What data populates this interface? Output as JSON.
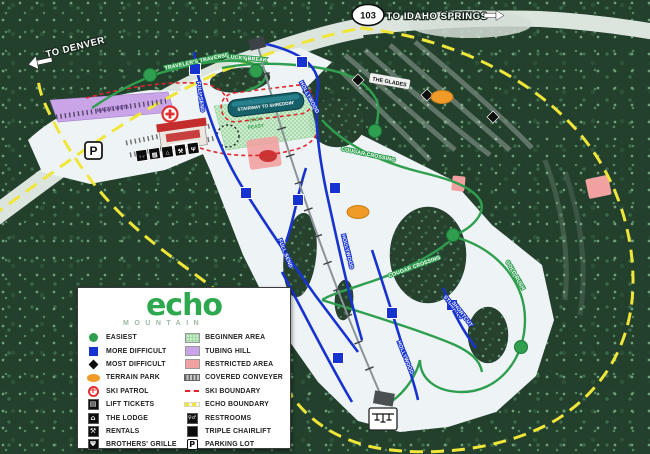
{
  "logo": {
    "name": "echo",
    "tagline": "MOUNTAIN"
  },
  "signs": {
    "route_shield": "103",
    "to_denver": "TO DENVER",
    "to_idaho_springs": "TO IDAHO SPRINGS"
  },
  "trail_labels": {
    "travelers_traverse": "TRAVELER'S TRAVERSE",
    "lucky_break": "LUCKY BREAK",
    "full_send": "FULL SEND",
    "hollywood": "HOLLYWOOD",
    "cougar_crossing": "COUGAR CROSSING",
    "gold_rush": "GOLD RUSH",
    "stumpys_line1": "STUMPY'S",
    "stumpys_line2": "SHORTCUT",
    "the_glades": "THE GLADES",
    "stairway_to_shreddin": "STAIRWAY TO SHREDDIN'",
    "magic_vista": "MAGIC VISTA",
    "beginner_line1": "EASY",
    "beginner_line2": "PEASY"
  },
  "icons": {
    "parking": "P",
    "patrol_cross": "+",
    "restrooms": "♀♂",
    "lift_tickets": "▤",
    "lodge": "⌂",
    "rentals": "⚒",
    "grille": "Ψ"
  },
  "legend": {
    "left": [
      {
        "icon": "green-circle",
        "label": "EASIEST"
      },
      {
        "icon": "blue-square",
        "label": "MORE DIFFICULT"
      },
      {
        "icon": "black-diamond",
        "label": "MOST DIFFICULT"
      },
      {
        "icon": "orange-oval",
        "label": "TERRAIN PARK"
      },
      {
        "icon": "ski-patrol",
        "label": "SKI PATROL"
      },
      {
        "icon": "lift-tickets",
        "label": "LIFT TICKETS"
      },
      {
        "icon": "lodge",
        "label": "THE LODGE"
      },
      {
        "icon": "rentals",
        "label": "RENTALS"
      },
      {
        "icon": "grille",
        "label": "BROTHERS' GRILLE"
      }
    ],
    "right": [
      {
        "icon": "beginner-area",
        "label": "BEGINNER AREA"
      },
      {
        "icon": "tubing-hill",
        "label": "TUBING HILL"
      },
      {
        "icon": "restricted-area",
        "label": "RESTRICTED AREA"
      },
      {
        "icon": "covered-conveyer",
        "label": "COVERED CONVEYER"
      },
      {
        "icon": "ski-boundary",
        "label": "SKI BOUNDARY"
      },
      {
        "icon": "echo-boundary",
        "label": "ECHO BOUNDARY"
      },
      {
        "icon": "restrooms",
        "label": "RESTROOMS"
      },
      {
        "icon": "triple-chairlift",
        "label": "TRIPLE CHAIRLIFT"
      },
      {
        "icon": "parking-lot",
        "label": "PARKING LOT"
      }
    ]
  },
  "colors": {
    "easiest_green": "#2f9e4f",
    "more_difficult_blue": "#1733cf",
    "terrain_park_orange": "#f09a28",
    "ski_boundary_red": "#e0262b",
    "echo_boundary_yellow": "#f0e63a",
    "tubing_purple": "#c9a4e6",
    "restricted_pink": "#f2a1a1",
    "conveyor_teal": "#156069",
    "logo_green": "#2ea84f"
  }
}
